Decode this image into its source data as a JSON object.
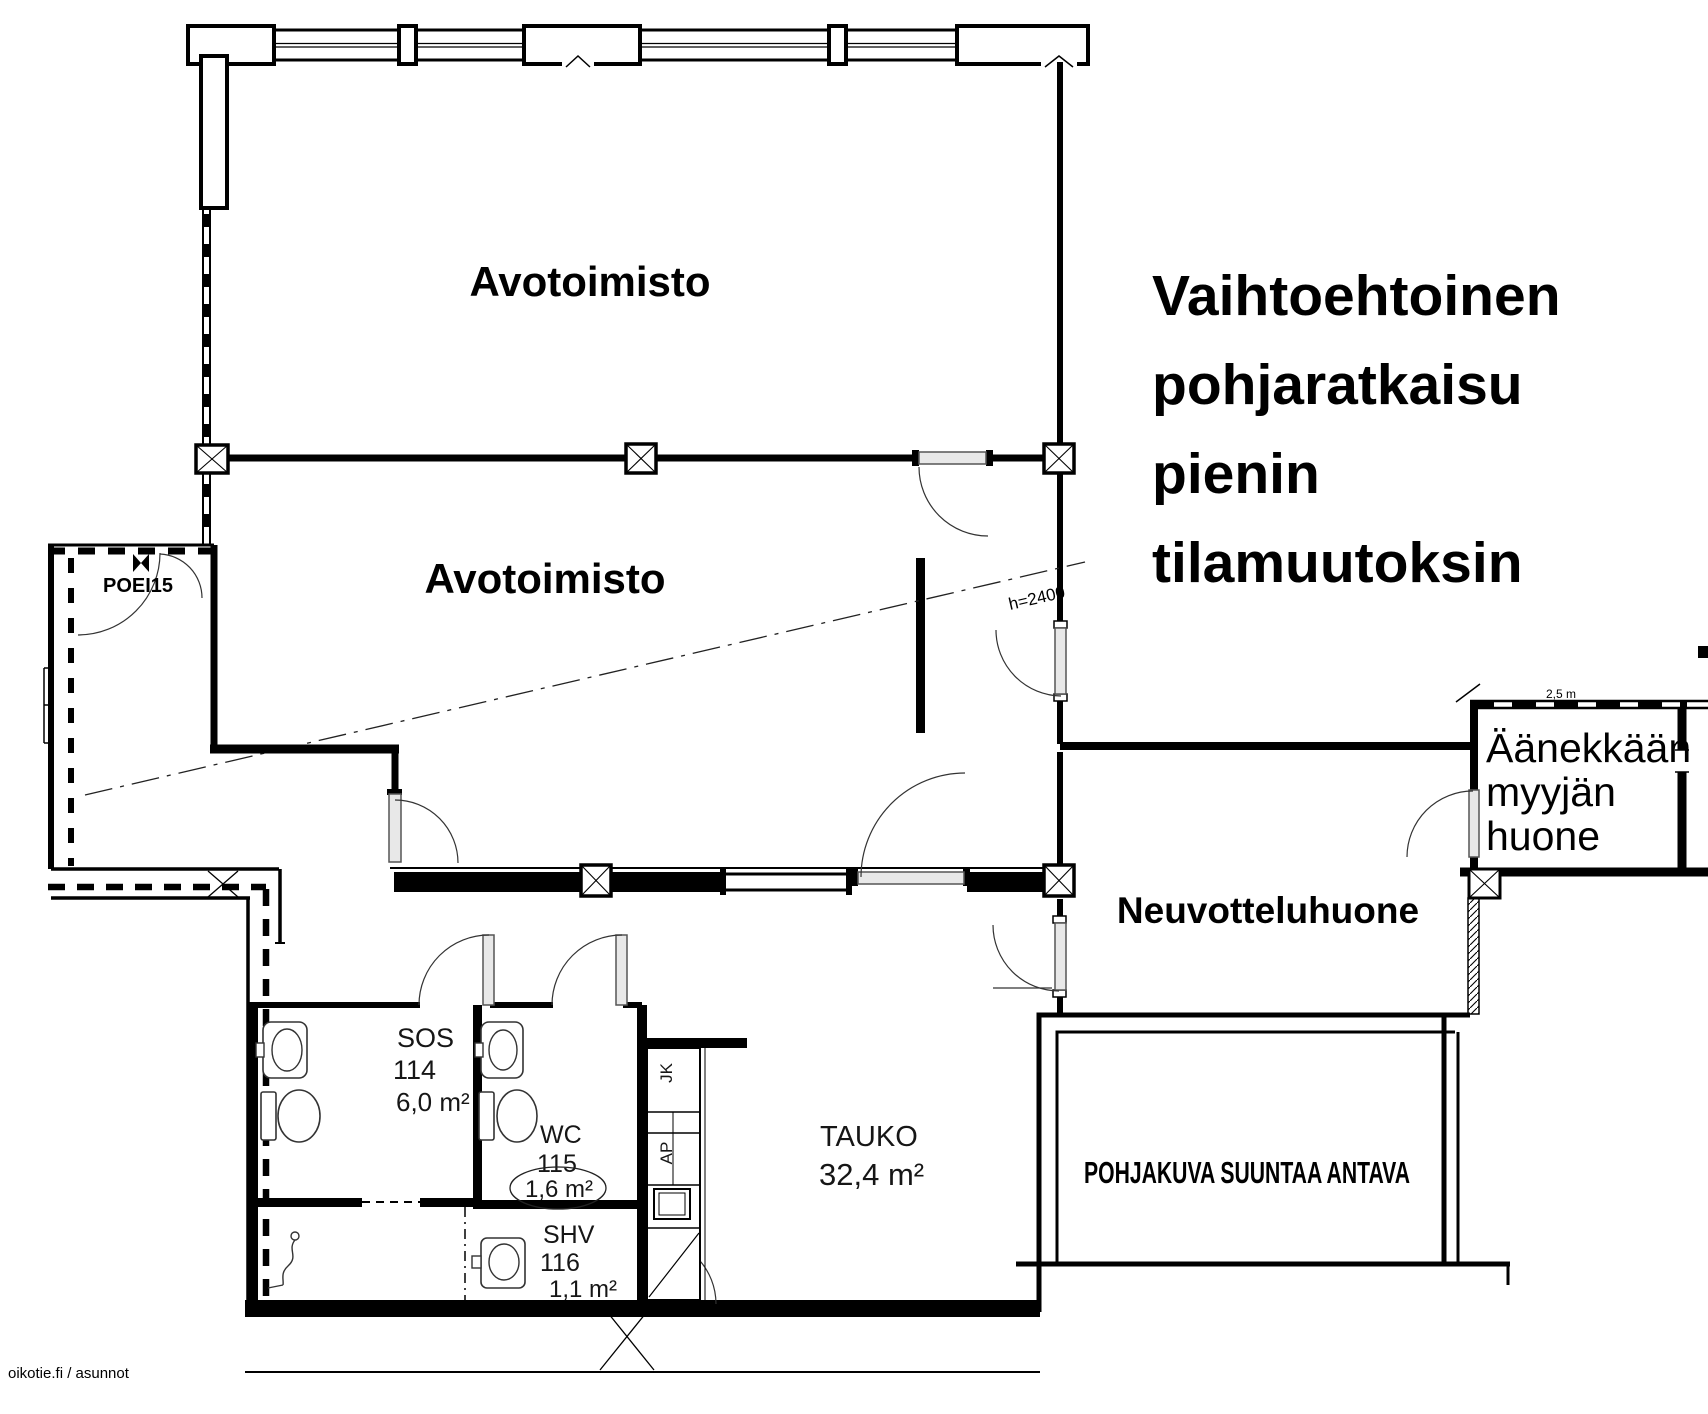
{
  "plan": {
    "title": {
      "lines": [
        "Vaihtoehtoinen",
        "pohjaratkaisu",
        "pienin",
        "tilamuutoksin"
      ]
    },
    "rooms": {
      "open_office_upper": {
        "label": "Avotoimisto"
      },
      "open_office_lower": {
        "label": "Avotoimisto"
      },
      "meeting_room": {
        "label": "Neuvotteluhuone"
      },
      "loud_seller_room": {
        "lines": [
          "Äänekkään",
          "myyjän",
          "huone"
        ]
      },
      "break_room": {
        "label": "TAUKO",
        "area": "32,4 m²"
      },
      "social_room": {
        "label": "SOS",
        "number": "114",
        "area": "6,0 m²"
      },
      "wc": {
        "label": "WC",
        "number": "115",
        "area": "1,6 m²"
      },
      "shv": {
        "label": "SHV",
        "number": "116",
        "area": "1,1 m²"
      }
    },
    "annotations": {
      "fire_door_code": "POEI15",
      "ceiling_height": "h=2400",
      "dimension": "2,5 m",
      "kitchen_fridge": "JK",
      "kitchen_counter": "AP",
      "disclaimer": "POHJAKUVA SUUNTAA ANTAVA",
      "watermark": "oikotie.fi / asunnot"
    }
  }
}
